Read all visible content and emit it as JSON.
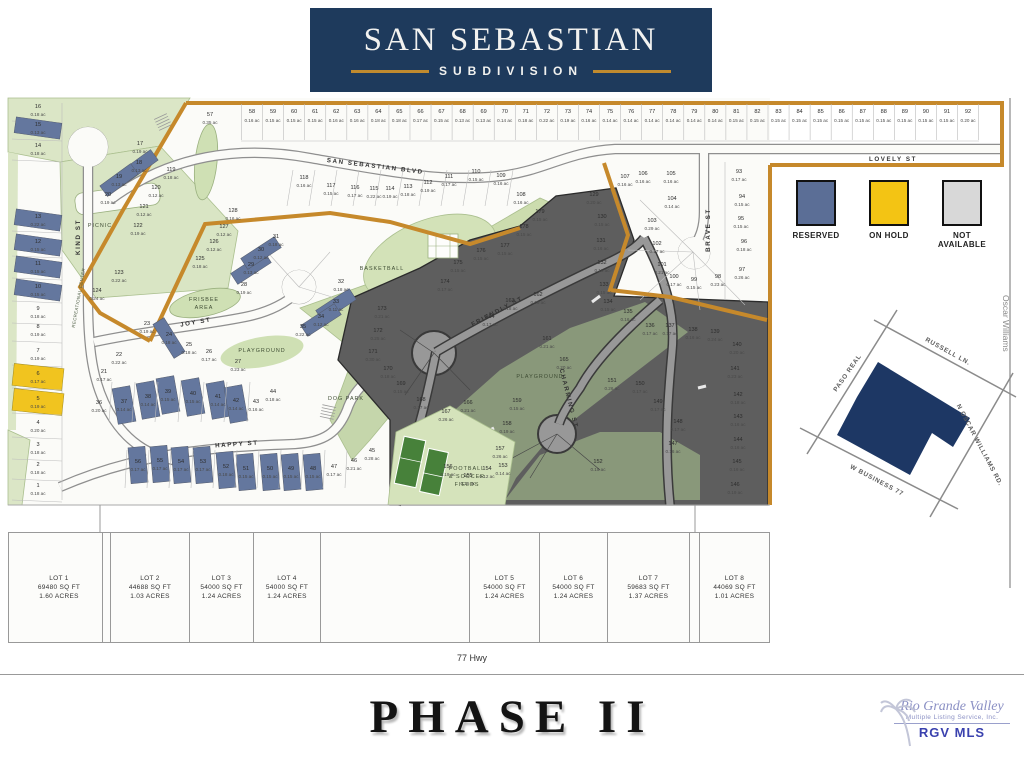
{
  "header": {
    "title": "SAN SEBASTIAN",
    "subtitle": "SUBDIVISION"
  },
  "legend": {
    "items": [
      {
        "label": "RESERVED",
        "color": "#5b6e96"
      },
      {
        "label": "ON HOLD",
        "color": "#f3c414"
      },
      {
        "label": "NOT AVAILABLE",
        "color": "#d8d8d8"
      }
    ]
  },
  "map": {
    "streets": [
      {
        "label": "SAN SEBASTIAN BLVD",
        "x": 375,
        "y": 168,
        "r": 7
      },
      {
        "label": "LOVELY ST",
        "x": 893,
        "y": 161,
        "r": 0
      },
      {
        "label": "KIND ST",
        "x": 80,
        "y": 237,
        "r": -90
      },
      {
        "label": "JOY ST",
        "x": 196,
        "y": 324,
        "r": -10
      },
      {
        "label": "HAPPY ST",
        "x": 237,
        "y": 446,
        "r": -4
      },
      {
        "label": "FRIENDLY ST",
        "x": 498,
        "y": 313,
        "r": -28
      },
      {
        "label": "CHARMING ST",
        "x": 567,
        "y": 399,
        "r": 76
      },
      {
        "label": "BRAVE ST",
        "x": 710,
        "y": 230,
        "r": -90
      }
    ],
    "amenities": [
      {
        "label": "PICNIC",
        "x": 100,
        "y": 227
      },
      {
        "label": "FRISBEE",
        "x": 204,
        "y": 301
      },
      {
        "label": "AREA",
        "x": 204,
        "y": 309
      },
      {
        "label": "PLAYGROUND",
        "x": 262,
        "y": 352
      },
      {
        "label": "BASKETBALL",
        "x": 382,
        "y": 270
      },
      {
        "label": "DOG PARK",
        "x": 346,
        "y": 400
      },
      {
        "label": "PLAYGROUND",
        "x": 540,
        "y": 378
      },
      {
        "label": "FOOTBALL",
        "x": 467,
        "y": 470
      },
      {
        "label": "& SOCCER",
        "x": 467,
        "y": 478
      },
      {
        "label": "FIELDS",
        "x": 467,
        "y": 486
      },
      {
        "label": "RECREATIONAL CENTER",
        "x": 80,
        "y": 298,
        "r": -80,
        "v": 1
      }
    ],
    "oscar": {
      "label": "Oscar Williams",
      "x": 1003,
      "y": 295
    },
    "top_row": {
      "lots": [
        [
          "58",
          "0.16"
        ],
        [
          "59",
          "0.15"
        ],
        [
          "60",
          "0.15"
        ],
        [
          "61",
          "0.15"
        ],
        [
          "62",
          "0.16"
        ],
        [
          "63",
          "0.16"
        ],
        [
          "64",
          "0.18"
        ],
        [
          "65",
          "0.18"
        ],
        [
          "66",
          "0.17"
        ],
        [
          "67",
          "0.15"
        ],
        [
          "68",
          "0.13"
        ],
        [
          "69",
          "0.13"
        ],
        [
          "70",
          "0.14"
        ],
        [
          "71",
          "0.18"
        ],
        [
          "72",
          "0.22"
        ],
        [
          "73",
          "0.19"
        ],
        [
          "74",
          "0.16"
        ],
        [
          "75",
          "0.14"
        ],
        [
          "76",
          "0.14"
        ],
        [
          "77",
          "0.14"
        ],
        [
          "78",
          "0.14"
        ],
        [
          "79",
          "0.14"
        ],
        [
          "80",
          "0.14"
        ],
        [
          "81",
          "0.15"
        ],
        [
          "82",
          "0.15"
        ],
        [
          "83",
          "0.15"
        ],
        [
          "84",
          "0.15"
        ],
        [
          "85",
          "0.15"
        ],
        [
          "86",
          "0.15"
        ],
        [
          "87",
          "0.15"
        ],
        [
          "88",
          "0.15"
        ],
        [
          "89",
          "0.15"
        ],
        [
          "90",
          "0.15"
        ],
        [
          "91",
          "0.15"
        ],
        [
          "92",
          "0.20"
        ]
      ]
    },
    "left_col": {
      "lots": [
        [
          "16",
          "0.18",
          108,
          ""
        ],
        [
          "15",
          "0.13",
          126,
          "b"
        ],
        [
          "14",
          "0.18",
          147,
          ""
        ],
        [
          "13",
          "0.22",
          218,
          "b"
        ],
        [
          "12",
          "0.15",
          243,
          "b"
        ],
        [
          "11",
          "0.15",
          265,
          "b"
        ],
        [
          "10",
          "0.15",
          288,
          "b"
        ],
        [
          "9",
          "0.18",
          310,
          ""
        ],
        [
          "8",
          "0.19",
          328,
          ""
        ],
        [
          "7",
          "0.19",
          352,
          ""
        ],
        [
          "6",
          "0.17",
          375,
          "y"
        ],
        [
          "5",
          "0.19",
          400,
          "y"
        ],
        [
          "4",
          "0.20",
          424,
          ""
        ],
        [
          "3",
          "0.18",
          446,
          ""
        ],
        [
          "2",
          "0.18",
          466,
          ""
        ],
        [
          "1",
          "0.18",
          487,
          ""
        ]
      ]
    },
    "lots": [
      [
        "57",
        "0.35",
        210,
        116
      ],
      [
        "17",
        "0.19",
        140,
        145
      ],
      [
        "18",
        "0.13",
        139,
        164,
        "b",
        38,
        13,
        -36
      ],
      [
        "19",
        "0.13",
        119,
        178,
        "b",
        38,
        13,
        -36
      ],
      [
        "20",
        "0.19",
        108,
        196
      ],
      [
        "119",
        "0.18",
        171,
        171
      ],
      [
        "120",
        "0.12",
        156,
        189
      ],
      [
        "121",
        "0.12",
        144,
        208
      ],
      [
        "122",
        "0.19",
        138,
        227
      ],
      [
        "123",
        "0.22",
        119,
        274
      ],
      [
        "124",
        "0.24",
        97,
        292
      ],
      [
        "125",
        "0.18",
        200,
        260
      ],
      [
        "126",
        "0.12",
        214,
        243
      ],
      [
        "127",
        "0.12",
        224,
        228
      ],
      [
        "128",
        "0.16",
        233,
        212
      ],
      [
        "21",
        "0.17",
        104,
        373
      ],
      [
        "22",
        "0.22",
        119,
        356
      ],
      [
        "23",
        "0.19",
        147,
        325
      ],
      [
        "24",
        "0.18",
        169,
        336,
        "b",
        13,
        40,
        -32
      ],
      [
        "25",
        "0.18",
        189,
        346
      ],
      [
        "26",
        "0.17",
        209,
        353
      ],
      [
        "27",
        "0.23",
        238,
        363
      ],
      [
        "28",
        "0.19",
        244,
        286
      ],
      [
        "29",
        "0.13",
        251,
        266,
        "b",
        40,
        13,
        -33
      ],
      [
        "30",
        "0.12",
        261,
        251,
        "b",
        40,
        13,
        -33
      ],
      [
        "31",
        "0.18",
        276,
        238
      ],
      [
        "32",
        "0.18",
        341,
        283
      ],
      [
        "33",
        "0.11",
        336,
        303,
        "b",
        40,
        13,
        -33
      ],
      [
        "34",
        "0.12",
        321,
        318,
        "b",
        40,
        13,
        -33
      ],
      [
        "35",
        "0.22",
        303,
        328
      ],
      [
        "36",
        "0.20",
        99,
        404
      ],
      [
        "37",
        "0.14",
        124,
        403,
        "b",
        18,
        36,
        -10
      ],
      [
        "38",
        "0.14",
        148,
        398,
        "b",
        18,
        36,
        -10
      ],
      [
        "39",
        "0.15",
        168,
        393,
        "b",
        18,
        36,
        -10
      ],
      [
        "40",
        "0.15",
        193,
        395,
        "b",
        18,
        36,
        -10
      ],
      [
        "41",
        "0.14",
        218,
        398,
        "b",
        18,
        36,
        -10
      ],
      [
        "42",
        "0.14",
        236,
        402,
        "b",
        18,
        36,
        -10
      ],
      [
        "43",
        "0.16",
        256,
        403
      ],
      [
        "44",
        "0.18",
        273,
        393
      ],
      [
        "45",
        "0.28",
        372,
        452
      ],
      [
        "46",
        "0.21",
        354,
        462
      ],
      [
        "47",
        "0.17",
        334,
        468
      ],
      [
        "48",
        "0.15",
        313,
        470,
        "b",
        17,
        36,
        -5
      ],
      [
        "49",
        "0.15",
        291,
        470,
        "b",
        17,
        36,
        -5
      ],
      [
        "50",
        "0.15",
        270,
        470,
        "b",
        17,
        36,
        -5
      ],
      [
        "51",
        "0.15",
        246,
        470,
        "b",
        17,
        36,
        -5
      ],
      [
        "52",
        "0.18",
        226,
        468,
        "b",
        17,
        36,
        -5
      ],
      [
        "53",
        "0.17",
        203,
        463,
        "b",
        17,
        36,
        -5
      ],
      [
        "54",
        "0.17",
        181,
        463,
        "b",
        17,
        36,
        -5
      ],
      [
        "55",
        "0.17",
        160,
        462,
        "b",
        17,
        36,
        -5
      ],
      [
        "56",
        "0.17",
        138,
        463,
        "b",
        17,
        36,
        -5
      ],
      [
        "118",
        "0.16",
        304,
        179
      ],
      [
        "117",
        "0.15",
        331,
        187
      ],
      [
        "116",
        "0.17",
        355,
        189
      ],
      [
        "115",
        "0.22",
        374,
        190
      ],
      [
        "114",
        "0.19",
        390,
        190
      ],
      [
        "113",
        "0.18",
        408,
        188
      ],
      [
        "112",
        "0.19",
        428,
        184
      ],
      [
        "111",
        "0.17",
        449,
        178
      ],
      [
        "110",
        "0.15",
        476,
        173
      ],
      [
        "109",
        "0.16",
        501,
        177
      ],
      [
        "108",
        "0.16",
        521,
        196
      ],
      [
        "107",
        "0.16",
        625,
        178
      ],
      [
        "106",
        "0.16",
        643,
        175
      ],
      [
        "105",
        "0.16",
        671,
        175
      ],
      [
        "104",
        "0.14",
        672,
        200
      ],
      [
        "103",
        "0.29",
        652,
        222
      ],
      [
        "102",
        "0.17",
        657,
        245
      ],
      [
        "101",
        "0.21",
        662,
        266
      ],
      [
        "100",
        "0.17",
        674,
        278
      ],
      [
        "99",
        "0.15",
        694,
        281
      ],
      [
        "98",
        "0.23",
        718,
        278
      ],
      [
        "97",
        "0.26",
        742,
        271
      ],
      [
        "96",
        "0.18",
        744,
        243
      ],
      [
        "95",
        "0.15",
        741,
        220
      ],
      [
        "94",
        "0.15",
        742,
        198
      ],
      [
        "93",
        "0.17",
        739,
        173
      ],
      [
        "129",
        "0.20",
        594,
        196
      ],
      [
        "130",
        "0.15",
        602,
        218
      ],
      [
        "131",
        "0.16",
        601,
        242
      ],
      [
        "132",
        "0.16",
        602,
        264
      ],
      [
        "133",
        "0.15",
        604,
        286
      ],
      [
        "134",
        "0.15",
        608,
        303
      ],
      [
        "135",
        "0.16",
        628,
        313
      ],
      [
        "136",
        "0.17",
        650,
        327
      ],
      [
        "137",
        "0.17",
        670,
        327
      ],
      [
        "138",
        "0.16",
        693,
        331
      ],
      [
        "139",
        "0.24",
        715,
        333
      ],
      [
        "140",
        "0.20",
        737,
        346
      ],
      [
        "141",
        "0.23",
        735,
        370
      ],
      [
        "142",
        "0.18",
        738,
        396
      ],
      [
        "143",
        "0.16",
        738,
        418
      ],
      [
        "144",
        "0.16",
        738,
        441
      ],
      [
        "145",
        "0.16",
        737,
        463
      ],
      [
        "146",
        "0.19",
        735,
        486
      ],
      [
        "147",
        "0.16",
        673,
        445
      ],
      [
        "148",
        "0.17",
        678,
        423
      ],
      [
        "149",
        "0.17",
        658,
        403
      ],
      [
        "150",
        "0.17",
        640,
        385
      ],
      [
        "151",
        "0.26",
        612,
        382
      ],
      [
        "152",
        "0.15",
        598,
        463
      ],
      [
        "153",
        "0.14",
        503,
        467
      ],
      [
        "154",
        "0.12",
        487,
        470
      ],
      [
        "155",
        "0.15",
        468,
        477
      ],
      [
        "156",
        "0.19",
        448,
        468
      ],
      [
        "157",
        "0.26",
        500,
        450
      ],
      [
        "158",
        "0.19",
        507,
        425
      ],
      [
        "159",
        "0.15",
        517,
        402
      ],
      [
        "161",
        "0.21",
        547,
        340
      ],
      [
        "162",
        "0.19",
        538,
        296
      ],
      [
        "163",
        "0.18",
        510,
        302
      ],
      [
        "164",
        "0.17",
        490,
        318
      ],
      [
        "165",
        "0.20",
        564,
        361
      ],
      [
        "166",
        "0.21",
        468,
        404
      ],
      [
        "167",
        "0.26",
        446,
        413
      ],
      [
        "168",
        "0.17",
        421,
        401
      ],
      [
        "169",
        "0.15",
        401,
        385
      ],
      [
        "170",
        "0.18",
        388,
        370
      ],
      [
        "171",
        "0.30",
        373,
        353
      ],
      [
        "172",
        "0.25",
        378,
        332
      ],
      [
        "173",
        "0.21",
        382,
        310
      ],
      [
        "174",
        "0.17",
        445,
        283
      ],
      [
        "175",
        "0.15",
        458,
        264
      ],
      [
        "176",
        "0.15",
        481,
        252
      ],
      [
        "177",
        "0.15",
        505,
        247
      ],
      [
        "178",
        "0.15",
        524,
        228
      ],
      [
        "179",
        "0.15",
        540,
        213
      ]
    ]
  },
  "inset": {
    "roads": [
      {
        "label": "PASO REAL",
        "x": 849,
        "y": 374,
        "r": -55
      },
      {
        "label": "RUSSELL LN.",
        "x": 947,
        "y": 353,
        "r": 29
      },
      {
        "label": "N OSCAR WILLIAMS RD.",
        "x": 978,
        "y": 446,
        "r": 62
      },
      {
        "label": "W BUSINESS 77",
        "x": 876,
        "y": 482,
        "r": 28
      }
    ]
  },
  "lot_strip": {
    "cells": [
      [
        8,
        87,
        "LOT 1",
        "69480 SQ FT",
        "1.60 ACRES"
      ],
      [
        95,
        8,
        "",
        "",
        ""
      ],
      [
        103,
        79,
        "LOT 2",
        "44688 SQ FT",
        "1.03 ACRES"
      ],
      [
        182,
        64,
        "LOT 3",
        "54000 SQ FT",
        "1.24 ACRES"
      ],
      [
        246,
        67,
        "LOT 4",
        "54000 SQ FT",
        "1.24 ACRES"
      ],
      [
        313,
        149,
        "",
        "",
        ""
      ],
      [
        462,
        70,
        "LOT 5",
        "54000 SQ FT",
        "1.24 ACRES"
      ],
      [
        532,
        68,
        "LOT 6",
        "54000 SQ FT",
        "1.24 ACRES"
      ],
      [
        600,
        82,
        "LOT 7",
        "59683 SQ FT",
        "1.37 ACRES"
      ],
      [
        682,
        10,
        "",
        "",
        ""
      ],
      [
        692,
        70,
        "LOT 8",
        "44069 SQ FT",
        "1.01 ACRES"
      ]
    ]
  },
  "highway": "77 Hwy",
  "phase": "PHASE II",
  "mls": {
    "line1": "Rio Grande Valley",
    "line2": "Multiple Listing Service, Inc.",
    "line3": "RGV MLS"
  }
}
